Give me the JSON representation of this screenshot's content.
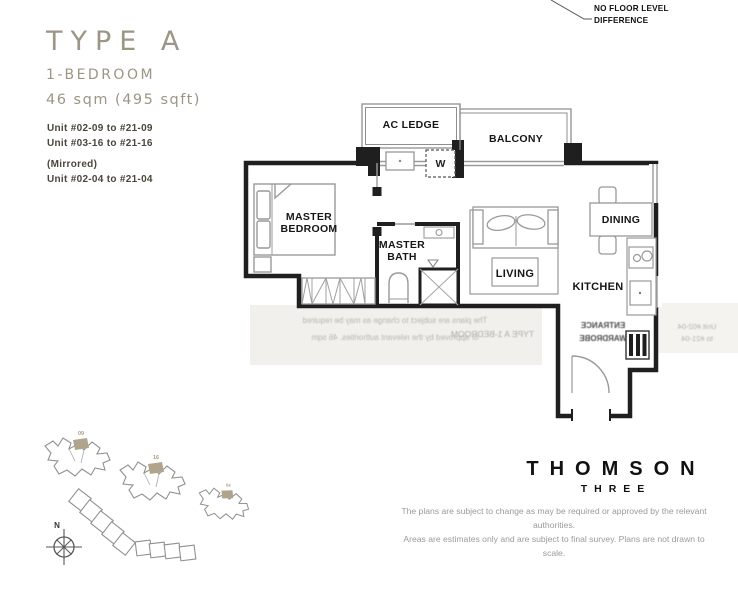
{
  "header": {
    "type_label": "TYPE A",
    "bedroom_label": "1-BEDROOM",
    "area_label": "46 sqm (495 sqft)"
  },
  "units": {
    "range1": "Unit #02-09 to #21-09",
    "range2": "Unit #03-16 to #21-16",
    "mirrored": "(Mirrored)",
    "range3": "Unit #02-04 to #21-04"
  },
  "note": {
    "line1": "NO FLOOR LEVEL",
    "line2": "DIFFERENCE"
  },
  "plan": {
    "ac_ledge": "AC LEDGE",
    "balcony": "BALCONY",
    "washer": "W",
    "master_line1": "MASTER",
    "master_line2": "BEDROOM",
    "bath_line1": "MASTER",
    "bath_line2": "BATH",
    "living": "LIVING",
    "dining": "DINING",
    "kitchen": "KITCHEN"
  },
  "watermarks": {
    "left_line1": "The plans are subject to change as may be required",
    "left_line2": "or approved by the relevant authorities. 46 sqm",
    "mid": "TYPE A 1-BEDROOM",
    "entrance_line1": "ENTRANCE",
    "entrance_line2": "WARDROBE",
    "right_line1": "Unit #02-04",
    "right_line2": "to #21-04"
  },
  "site_plan": {
    "north": "N",
    "stacks": [
      "09",
      "16",
      "04"
    ]
  },
  "brand": {
    "name": "THOMSON",
    "sub": "THREE"
  },
  "disclaimer": {
    "line1": "The plans are subject to change as may be required or approved by the relevant authorities.",
    "line2": "Areas are estimates only and are subject to final survey. Plans are not drawn to scale."
  },
  "colors": {
    "accent": "#9d9585",
    "highlight": "#b0a58c",
    "wall": "#1f1f1f"
  }
}
